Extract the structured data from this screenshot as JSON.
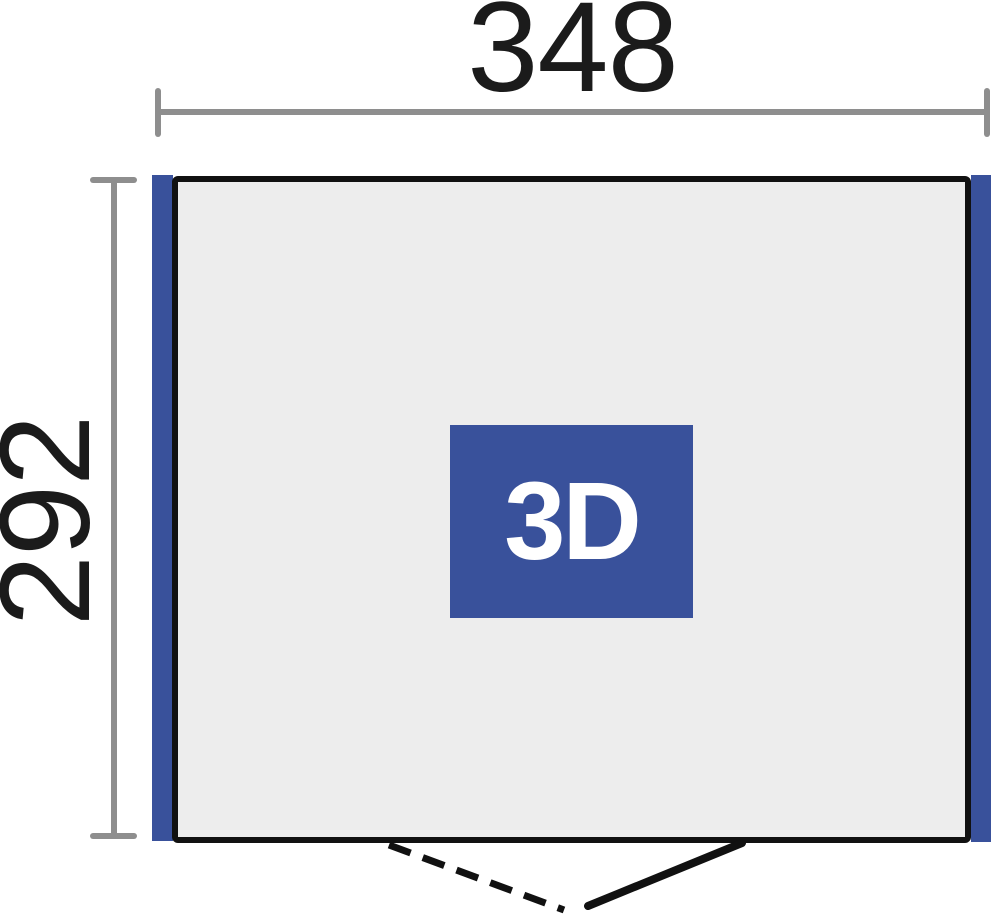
{
  "diagram": {
    "dimensions": {
      "width": {
        "label": "348"
      },
      "height": {
        "label": "292"
      }
    },
    "badge": {
      "label": "3D"
    },
    "colors": {
      "accent_blue": "#39519B",
      "panel_fill": "#EDEDED",
      "dimension_gray": "#8E8E8E",
      "line_black": "#111111",
      "badge_text": "#FFFFFF"
    }
  }
}
